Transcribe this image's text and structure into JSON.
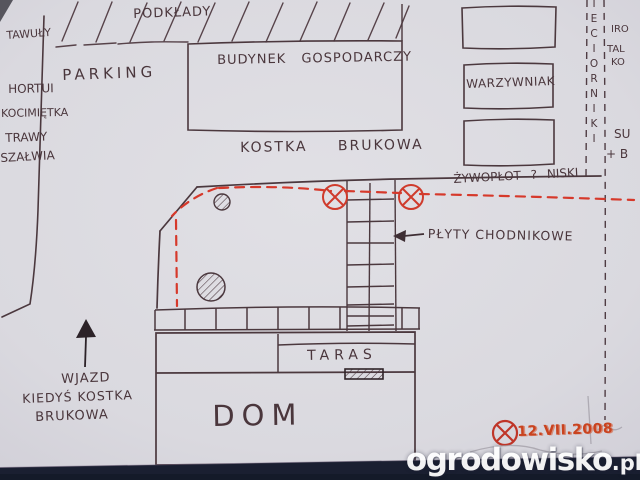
{
  "plan": {
    "area_labels": {
      "top_strip": "PODKŁADY",
      "parking": "PARKING",
      "outbuilding": "BUDYNEK GOSPODARCZY",
      "paving": "KOSTKA BRUKOWA",
      "vegetable_patch": "WARZYWNIAK",
      "hedge_note": "ŻYWOPŁOT ? NISKI",
      "walkway_note": "PŁYTY CHODNIKOWE",
      "terrace": "TARAS",
      "house": "DOM"
    },
    "driveway_note": [
      "WJAZD",
      "KIEDYŚ KOSTKA",
      "BRUKOWA"
    ],
    "left_plants": [
      "TAWUŁY",
      "HORTUI",
      "KOCIMIĘTKA",
      "TRAWY",
      "SZAŁWIA"
    ],
    "right_boundary_vertical_label": "IECIORNIKI",
    "right_edge_fragments": [
      "IRO",
      "TAL",
      "KO",
      "SU",
      "+ B"
    ],
    "date_note": "12.VII.2008"
  },
  "watermark": {
    "name": "ogrodowisko",
    "tld": ".pl"
  },
  "colors": {
    "red_ink": "#d13a2b",
    "dark_ink": "#4b383e",
    "paper": "#d9d8de",
    "background_navy": "#1a1f31",
    "watermark_white": "#ffffff"
  }
}
